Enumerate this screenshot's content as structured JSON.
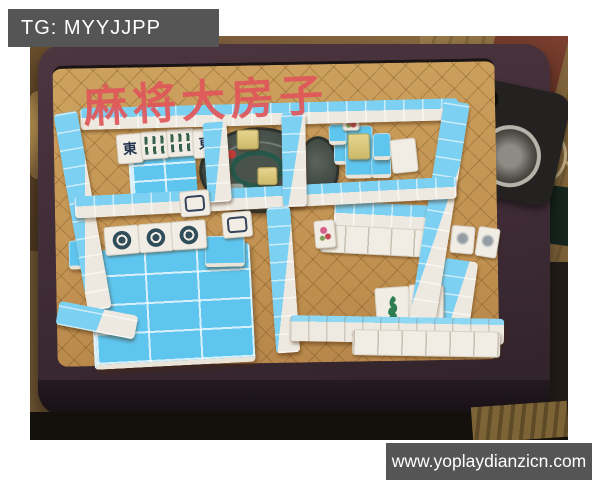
{
  "watermarks": {
    "telegram": "TG: MYYJJPP",
    "website": "www.yoplaydianzicn.com"
  },
  "caption": {
    "text": "麻将大房子",
    "color": "#df565a"
  },
  "tile_labels": {
    "east_wind": "東"
  },
  "icons": {
    "bamboo_tile": "green-bar-cluster",
    "dots_tile": "dark-dot-ring",
    "white_dragon_tile": "framed-rectangle",
    "bird_tile": "green-bird-glyph",
    "flower_tile": "pink-petal-glyph",
    "cup_holder": "metal-cup-ring",
    "control_dial": "round-control-panel"
  },
  "colors": {
    "tile_blue": "#5ec5ee",
    "tile_white": "#f1ede4",
    "table_felt": "#c49455",
    "table_rail": "#44303a",
    "gold_tile": "#d9c47c",
    "dial_gray": "#424a44",
    "watermark_bg": "#555555"
  }
}
